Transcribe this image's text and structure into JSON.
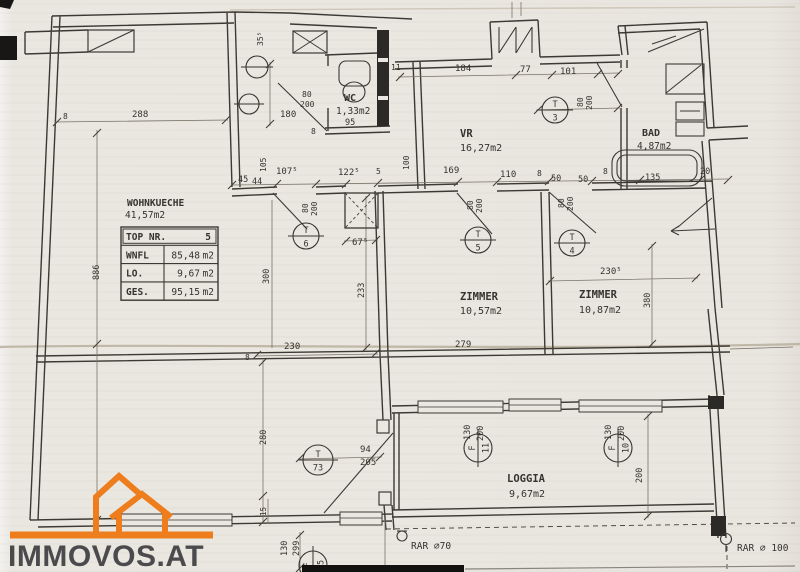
{
  "colors": {
    "paper": "#eae7e1",
    "ink": "#36332e",
    "faint": "#7a7468",
    "crease": "#b9af9e",
    "orange": "#ed7d1d",
    "logo_text": "#4b4b4d"
  },
  "logo": {
    "text": "IMMOVOS.AT"
  },
  "info_table": {
    "rows": [
      {
        "label": "TOP NR.",
        "value": "5",
        "unit": ""
      },
      {
        "label": "WNFL",
        "value": "85,48",
        "unit": "m2"
      },
      {
        "label": "LO.",
        "value": "9,67",
        "unit": "m2"
      },
      {
        "label": "GES.",
        "value": "95,15",
        "unit": "m2"
      }
    ]
  },
  "rooms": [
    {
      "name": "WOHNKUECHE",
      "area": "41,57m2"
    },
    {
      "name": "WC",
      "area": "1,33m2"
    },
    {
      "name": "VR",
      "area": "16,27m2"
    },
    {
      "name": "BAD",
      "area": "4,87m2"
    },
    {
      "name": "ZIMMER",
      "area": "10,57m2"
    },
    {
      "name": "ZIMMER",
      "area": "10,87m2"
    },
    {
      "name": "LOGGIA",
      "area": "9,67m2"
    }
  ],
  "labels": [
    {
      "n": "room-label-wohnkueche",
      "t": "WOHNKUECHE",
      "x": 127,
      "y": 206,
      "s": 9.5,
      "b": 1
    },
    {
      "n": "room-area-wohnkueche",
      "t": "41,57m2",
      "x": 125,
      "y": 218,
      "s": 9.5
    },
    {
      "n": "room-label-wc",
      "t": "WC",
      "x": 344,
      "y": 101,
      "s": 10,
      "b": 1
    },
    {
      "n": "room-area-wc",
      "t": "1,33m2",
      "x": 336,
      "y": 114,
      "s": 9.5
    },
    {
      "n": "room-label-vr",
      "t": "VR",
      "x": 460,
      "y": 137,
      "s": 10.5,
      "b": 1
    },
    {
      "n": "room-area-vr",
      "t": "16,27m2",
      "x": 460,
      "y": 151,
      "s": 10
    },
    {
      "n": "room-label-bad",
      "t": "BAD",
      "x": 642,
      "y": 136,
      "s": 10,
      "b": 1
    },
    {
      "n": "room-area-bad",
      "t": "4,87m2",
      "x": 637,
      "y": 149,
      "s": 9.5
    },
    {
      "n": "room-label-zimmer-1",
      "t": "ZIMMER",
      "x": 479,
      "y": 300,
      "s": 10.5,
      "a": "m",
      "b": 1
    },
    {
      "n": "room-area-zimmer-1",
      "t": "10,57m2",
      "x": 481,
      "y": 314,
      "s": 10,
      "a": "m"
    },
    {
      "n": "room-label-zimmer-2",
      "t": "ZIMMER",
      "x": 598,
      "y": 298,
      "s": 10.5,
      "a": "m",
      "b": 1
    },
    {
      "n": "room-area-zimmer-2",
      "t": "10,87m2",
      "x": 600,
      "y": 313,
      "s": 10,
      "a": "m"
    },
    {
      "n": "room-label-loggia",
      "t": "LOGGIA",
      "x": 526,
      "y": 482,
      "s": 10.5,
      "a": "m",
      "b": 1
    },
    {
      "n": "room-area-loggia",
      "t": "9,67m2",
      "x": 527,
      "y": 497,
      "s": 10,
      "a": "m"
    },
    {
      "n": "dim-288",
      "t": "288",
      "x": 132,
      "y": 117,
      "s": 9
    },
    {
      "n": "dim-8-a",
      "t": "8",
      "x": 63,
      "y": 119,
      "s": 8,
      "l": 1
    },
    {
      "n": "dim-35-5",
      "t": "35⁵",
      "x": 263,
      "y": 46,
      "s": 8,
      "rot": 1,
      "l": 1
    },
    {
      "n": "dim-184",
      "t": "184",
      "x": 455,
      "y": 71,
      "s": 9
    },
    {
      "n": "dim-77",
      "t": "77",
      "x": 520,
      "y": 72,
      "s": 9,
      "l": 1
    },
    {
      "n": "dim-101",
      "t": "101",
      "x": 560,
      "y": 74,
      "s": 9,
      "l": 1
    },
    {
      "n": "dim-180",
      "t": "180",
      "x": 280,
      "y": 117,
      "s": 9
    },
    {
      "n": "dim-wc-door-80",
      "t": "80",
      "x": 302,
      "y": 97,
      "s": 8
    },
    {
      "n": "dim-wc-door-200",
      "t": "200",
      "x": 300,
      "y": 107,
      "s": 8,
      "l": 1
    },
    {
      "n": "dim-8-b",
      "t": "8",
      "x": 311,
      "y": 134,
      "s": 8
    },
    {
      "n": "dim-95",
      "t": "95",
      "x": 345,
      "y": 125,
      "s": 8.5
    },
    {
      "n": "dim-11",
      "t": "11",
      "x": 391,
      "y": 70,
      "s": 8,
      "l": 1
    },
    {
      "n": "dim-100-v",
      "t": "100",
      "x": 409,
      "y": 170,
      "s": 8,
      "rot": 1,
      "l": 1
    },
    {
      "n": "dim-105-v",
      "t": "105",
      "x": 266,
      "y": 172,
      "s": 8,
      "rot": 1,
      "l": 1
    },
    {
      "n": "dim-45",
      "t": "45",
      "x": 238,
      "y": 182,
      "s": 8.5
    },
    {
      "n": "dim-44",
      "t": "44",
      "x": 252,
      "y": 184,
      "s": 8.5,
      "l": 1
    },
    {
      "n": "dim-107-5",
      "t": "107⁵",
      "x": 276,
      "y": 174,
      "s": 9
    },
    {
      "n": "dim-122-5",
      "t": "122⁵",
      "x": 338,
      "y": 175,
      "s": 9
    },
    {
      "n": "dim-5",
      "t": "5",
      "x": 376,
      "y": 174,
      "s": 8,
      "l": 1
    },
    {
      "n": "dim-169",
      "t": "169",
      "x": 443,
      "y": 173,
      "s": 9
    },
    {
      "n": "dim-110",
      "t": "110",
      "x": 500,
      "y": 177,
      "s": 9
    },
    {
      "n": "dim-8-c",
      "t": "8",
      "x": 537,
      "y": 176,
      "s": 8,
      "l": 1
    },
    {
      "n": "dim-50-a",
      "t": "50",
      "x": 551,
      "y": 181,
      "s": 8.5
    },
    {
      "n": "dim-50-b",
      "t": "50",
      "x": 578,
      "y": 182,
      "s": 8.5
    },
    {
      "n": "dim-8-d",
      "t": "8",
      "x": 603,
      "y": 174,
      "s": 8,
      "l": 1
    },
    {
      "n": "dim-135",
      "t": "135",
      "x": 645,
      "y": 180,
      "s": 8.5,
      "l": 1
    },
    {
      "n": "dim-20",
      "t": "20",
      "x": 700,
      "y": 174,
      "s": 8.5,
      "l": 1
    },
    {
      "n": "dim-t6-80",
      "t": "80",
      "x": 308,
      "y": 213,
      "s": 8,
      "rot": 1
    },
    {
      "n": "dim-t6-200",
      "t": "200",
      "x": 317,
      "y": 216,
      "s": 8,
      "rot": 1
    },
    {
      "n": "dim-t5-80",
      "t": "80",
      "x": 473,
      "y": 210,
      "s": 8,
      "rot": 1
    },
    {
      "n": "dim-t5-200",
      "t": "200",
      "x": 482,
      "y": 213,
      "s": 8,
      "rot": 1
    },
    {
      "n": "dim-t4-80",
      "t": "80",
      "x": 564,
      "y": 208,
      "s": 8,
      "rot": 1
    },
    {
      "n": "dim-t4-200",
      "t": "200",
      "x": 573,
      "y": 211,
      "s": 8,
      "rot": 1
    },
    {
      "n": "dim-t3-80",
      "t": "80",
      "x": 583,
      "y": 107,
      "s": 8,
      "rot": 1
    },
    {
      "n": "dim-t3-200",
      "t": "200",
      "x": 592,
      "y": 110,
      "s": 8,
      "rot": 1
    },
    {
      "n": "dim-67-5",
      "t": "67⁵",
      "x": 352,
      "y": 245,
      "s": 9
    },
    {
      "n": "dim-230-5",
      "t": "230⁵",
      "x": 600,
      "y": 274,
      "s": 9
    },
    {
      "n": "dim-380",
      "t": "380",
      "x": 650,
      "y": 308,
      "s": 8.5,
      "rot": 1,
      "l": 1
    },
    {
      "n": "dim-233",
      "t": "233",
      "x": 364,
      "y": 298,
      "s": 8.5,
      "rot": 1
    },
    {
      "n": "dim-300",
      "t": "300",
      "x": 269,
      "y": 284,
      "s": 8.5,
      "rot": 1
    },
    {
      "n": "dim-886",
      "t": "886",
      "x": 99,
      "y": 280,
      "s": 8.5,
      "rot": 1
    },
    {
      "n": "dim-279",
      "t": "279",
      "x": 455,
      "y": 347,
      "s": 9
    },
    {
      "n": "dim-230",
      "t": "230",
      "x": 284,
      "y": 349,
      "s": 9
    },
    {
      "n": "dim-8-e",
      "t": "8",
      "x": 245,
      "y": 360,
      "s": 8
    },
    {
      "n": "dim-280",
      "t": "280",
      "x": 266,
      "y": 445,
      "s": 8.5,
      "rot": 1
    },
    {
      "n": "dim-94",
      "t": "94",
      "x": 360,
      "y": 452,
      "s": 9
    },
    {
      "n": "dim-205",
      "t": "205",
      "x": 360,
      "y": 465,
      "s": 9
    },
    {
      "n": "dim-f11-130",
      "t": "130",
      "x": 470,
      "y": 440,
      "s": 8.5,
      "rot": 1
    },
    {
      "n": "dim-f11-200",
      "t": "200",
      "x": 483,
      "y": 441,
      "s": 8.5,
      "rot": 1
    },
    {
      "n": "dim-f10-130",
      "t": "130",
      "x": 611,
      "y": 440,
      "s": 8.5,
      "rot": 1
    },
    {
      "n": "dim-f10-200",
      "t": "200",
      "x": 624,
      "y": 441,
      "s": 8.5,
      "rot": 1
    },
    {
      "n": "dim-loggia-200",
      "t": "200",
      "x": 642,
      "y": 483,
      "s": 8.5,
      "rot": 1
    },
    {
      "n": "dim-130-a",
      "t": "130",
      "x": 287,
      "y": 556,
      "s": 8.5,
      "rot": 1
    },
    {
      "n": "dim-130-b",
      "t": "299",
      "x": 299,
      "y": 556,
      "s": 8.5,
      "rot": 1
    },
    {
      "n": "dim-15",
      "t": "15",
      "x": 266,
      "y": 516,
      "s": 7.5,
      "rot": 1,
      "l": 1
    },
    {
      "n": "annotation-rar-left",
      "t": "RAR ∅70",
      "x": 411,
      "y": 549,
      "s": 9.5
    },
    {
      "n": "annotation-rar-right",
      "t": "RAR ∅ 100",
      "x": 737,
      "y": 551,
      "s": 9.5
    }
  ],
  "tags": [
    {
      "n": "door-tag-t6",
      "top": "T",
      "bot": "6",
      "x": 306,
      "y": 236,
      "r": 13
    },
    {
      "n": "door-tag-t5",
      "top": "T",
      "bot": "5",
      "x": 478,
      "y": 240,
      "r": 13
    },
    {
      "n": "door-tag-t4",
      "top": "T",
      "bot": "4",
      "x": 572,
      "y": 243,
      "r": 13
    },
    {
      "n": "door-tag-t3",
      "top": "T",
      "bot": "3",
      "x": 555,
      "y": 110,
      "r": 13
    },
    {
      "n": "door-tag-t73",
      "top": "T",
      "bot": "73",
      "x": 318,
      "y": 460,
      "r": 15
    },
    {
      "n": "window-tag-f11",
      "top": "F",
      "bot": "11",
      "x": 478,
      "y": 448,
      "r": 14,
      "rot": 1
    },
    {
      "n": "window-tag-f10",
      "top": "F",
      "bot": "10",
      "x": 618,
      "y": 448,
      "r": 14,
      "rot": 1
    },
    {
      "n": "window-tag-f15",
      "top": "F",
      "bot": "15",
      "x": 313,
      "y": 565,
      "r": 14,
      "rot": 1
    },
    {
      "n": "fixture-circle-a",
      "top": "",
      "bot": "",
      "x": 257,
      "y": 67,
      "r": 11
    },
    {
      "n": "fixture-circle-b",
      "top": "",
      "bot": "",
      "x": 249,
      "y": 104,
      "r": 10
    }
  ]
}
